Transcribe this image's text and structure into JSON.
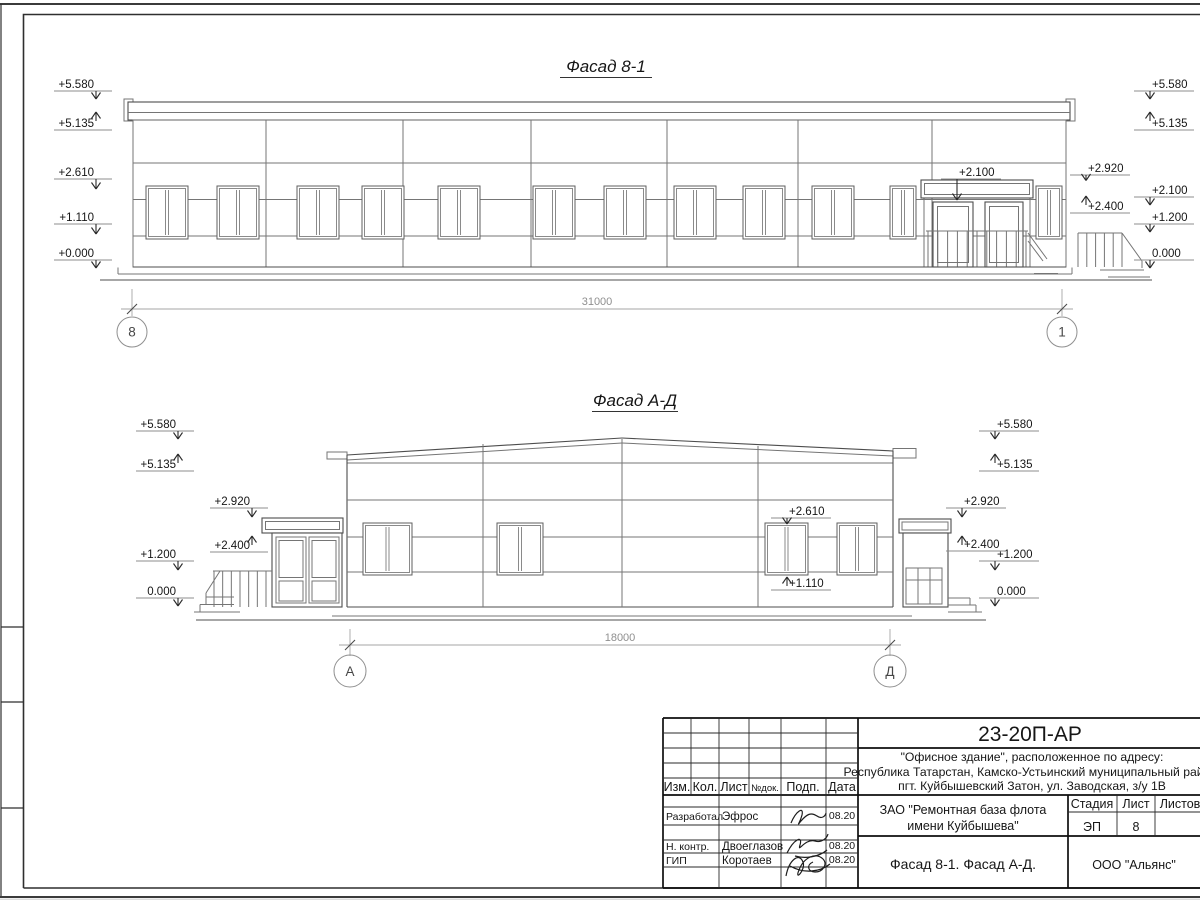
{
  "sheet": {
    "facade81": {
      "title": "Фасад 8-1",
      "dim": "31000",
      "axis_left": "8",
      "axis_right": "1",
      "door_mark": "+2.100",
      "left_marks": [
        "+5.580",
        "+5.135",
        "+2.610",
        "+1.110",
        "+0.000"
      ],
      "right_marks": [
        "+5.580",
        "+5.135",
        "+2.100",
        "+1.200",
        "0.000"
      ],
      "right_inner_marks": [
        "+2.920",
        "+2.400"
      ]
    },
    "facadeAD": {
      "title": "Фасад А-Д",
      "dim": "18000",
      "axis_left": "А",
      "axis_right": "Д",
      "left_marks": [
        "+5.580",
        "+5.135",
        "+1.200",
        "0.000"
      ],
      "left_inner_marks": [
        "+2.920",
        "+2.400"
      ],
      "right_marks": [
        "+5.580",
        "+5.135",
        "+1.200",
        "0.000"
      ],
      "right_inner_marks": [
        "+2.920",
        "+2.400"
      ],
      "window_marks": [
        "+2.610",
        "+1.110"
      ]
    },
    "titleblock": {
      "doc_code": "23-20П-АР",
      "object_lines": [
        "\"Офисное здание\", расположенное по адресу:",
        "Республика Татарстан, Камско-Устьинский муниципальный район,",
        "пгт. Куйбышевский Затон, ул. Заводская, з/у 1В"
      ],
      "client_lines": [
        "ЗАО \"Ремонтная база флота",
        "имени Куйбышева\""
      ],
      "sheet_title": "Фасад 8-1. Фасад А-Д.",
      "company": "ООО \"Альянс\"",
      "columns": {
        "izm": "Изм.",
        "kol": "Кол.",
        "list": "Лист",
        "ndoc": "№док.",
        "podp": "Подп.",
        "data": "Дата"
      },
      "stage_cols": {
        "stage": "Стадия",
        "sheet": "Лист",
        "sheets": "Листов"
      },
      "stage_value": "ЭП",
      "sheet_value": "8",
      "rows": [
        {
          "role": "Разработал",
          "name": "Эфрос",
          "date": "08.20"
        },
        {
          "role": "Н. контр.",
          "name": "Двоеглазов",
          "date": "08.20"
        },
        {
          "role": "ГИП",
          "name": "Коротаев",
          "date": "08.20"
        }
      ]
    }
  }
}
